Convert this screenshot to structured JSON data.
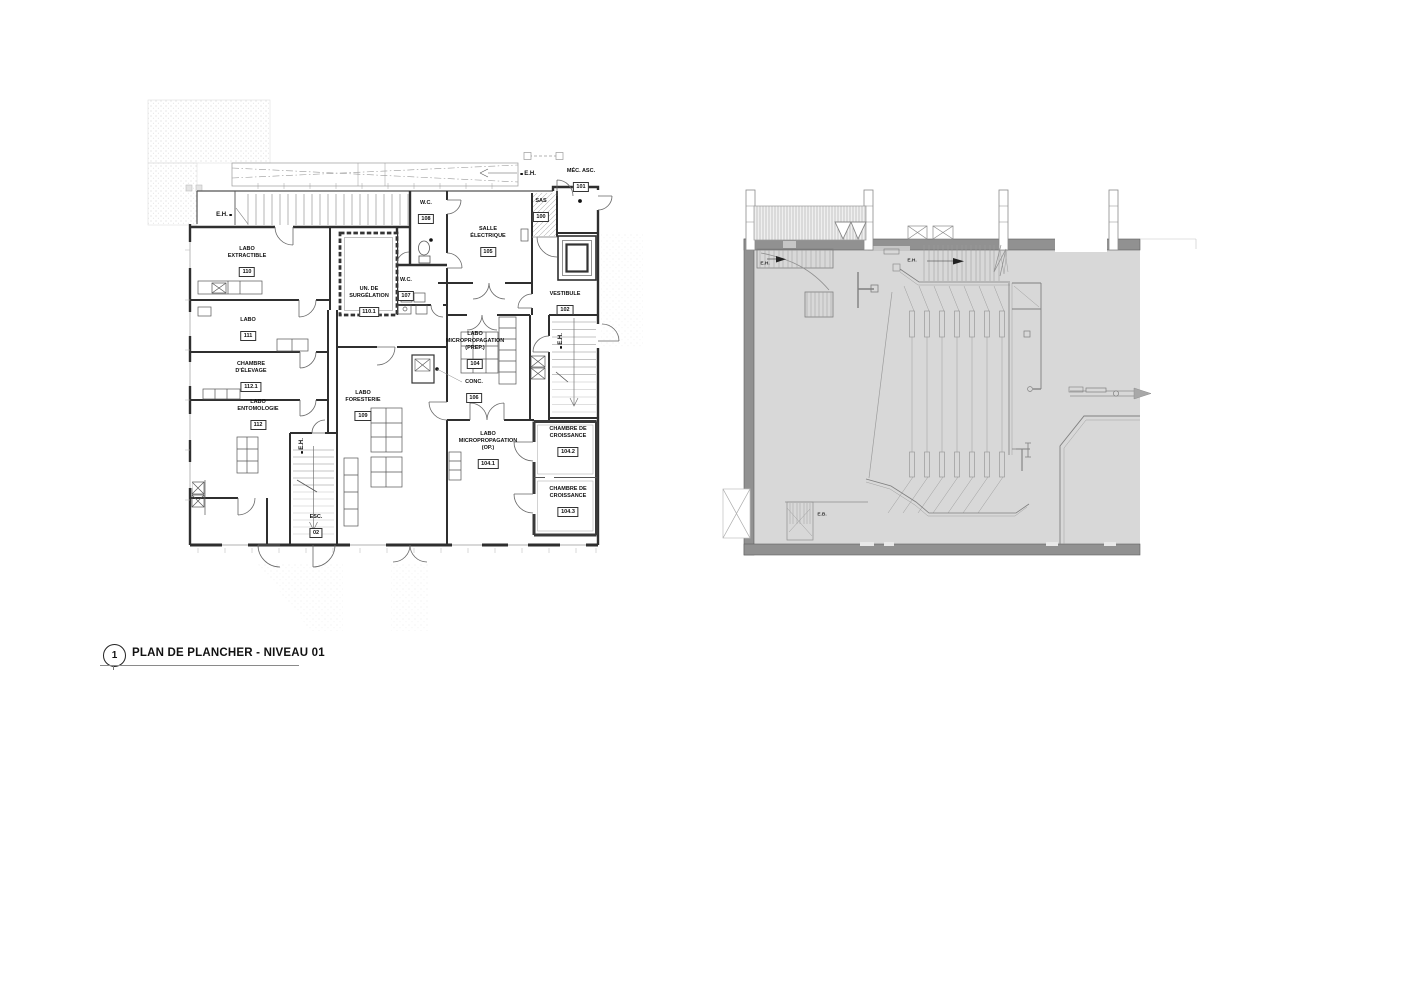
{
  "sheet": {
    "callout": {
      "number": "1",
      "title": "PLAN DE PLANCHER - NIVEAU 01"
    }
  },
  "colors": {
    "paper": "#ffffff",
    "line_dark": "#2f2f2f",
    "line_mid": "#8a8a8a",
    "plan_fill_gray": "#d8d8d8",
    "wall_gray": "#919191",
    "sas_fill": "#e4e4e4"
  },
  "left_plan": {
    "rooms": [
      {
        "name": "LABO\nEXTRACTIBLE",
        "number": "110"
      },
      {
        "name": "W.C.",
        "number": "108"
      },
      {
        "name": "SALLE\nÉLECTRIQUE",
        "number": "105"
      },
      {
        "name": "SAS",
        "number": "100"
      },
      {
        "name": "MÉC. ASC.",
        "number": "101"
      },
      {
        "name": "UN. DE\nSURGÉLATION",
        "number": "110.1"
      },
      {
        "name": "W.C.",
        "number": "107"
      },
      {
        "name": "VESTIBULE",
        "number": "102"
      },
      {
        "name": "LABO",
        "number": "111"
      },
      {
        "name": "LABO\nMICROPROPAGATION\n(PREP.)",
        "number": "104"
      },
      {
        "name": "CHAMBRE\nD'ÉLEVAGE",
        "number": "112.1"
      },
      {
        "name": "CONC.",
        "number": "106"
      },
      {
        "name": "LABO\nFORESTERIE",
        "number": "109"
      },
      {
        "name": "LABO\nENTOMOLOGIE",
        "number": "112"
      },
      {
        "name": "LABO\nMICROPROPAGATION\n(OP.)",
        "number": "104.1"
      },
      {
        "name": "CHAMBRE DE\nCROISSANCE",
        "number": "104.2"
      },
      {
        "name": "CHAMBRE DE\nCROISSANCE",
        "number": "104.3"
      },
      {
        "name": "ESC.",
        "number": "02"
      }
    ],
    "annotations": [
      {
        "label": "E.H."
      },
      {
        "label": "E.H."
      },
      {
        "label": "E.H."
      },
      {
        "label": "E.H."
      }
    ]
  },
  "right_plan": {
    "annotations": [
      {
        "label": "E.H."
      },
      {
        "label": "E.H."
      },
      {
        "label": "E.B."
      }
    ]
  }
}
